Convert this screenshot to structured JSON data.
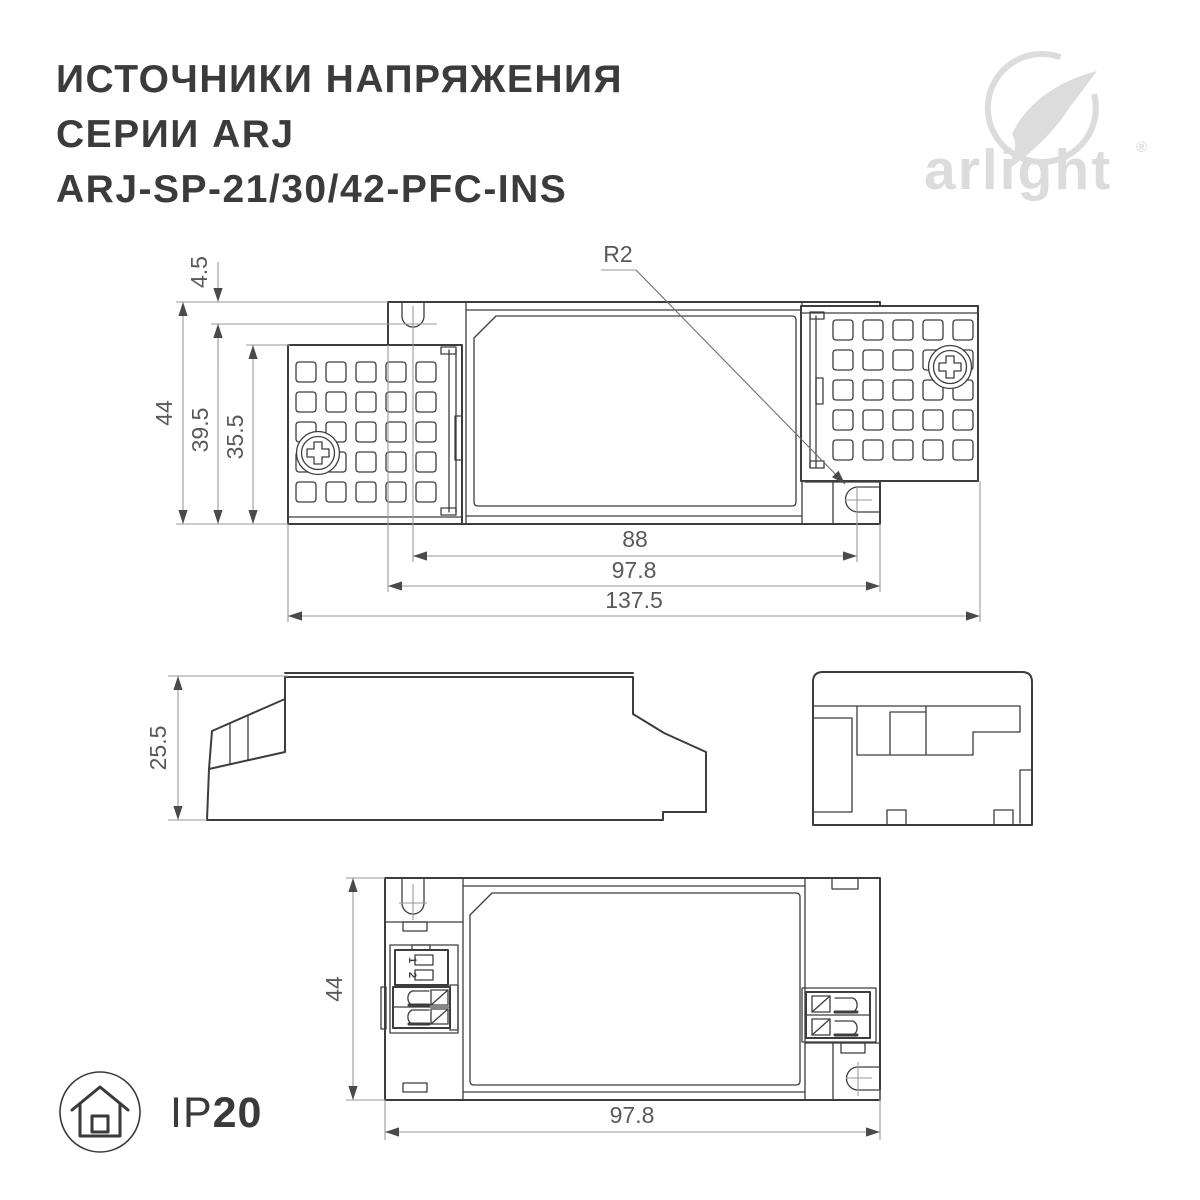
{
  "colors": {
    "line": "#3d3d3d",
    "dim": "#9a9a9a",
    "dimtext": "#595959",
    "arrow": "#4a4a4a",
    "title": "#3b3b3b",
    "logo": "#dcdcdc",
    "badge": "#3a3a3a"
  },
  "header": {
    "line1": "ИСТОЧНИКИ НАПРЯЖЕНИЯ",
    "line2": "СЕРИИ ARJ",
    "line3": "ARJ-SP-21/30/42-PFC-INS"
  },
  "logo": {
    "wordmark": "arlight",
    "registered": "®"
  },
  "views": {
    "top": {
      "d44": "44",
      "d45": "4.5",
      "d395": "39.5",
      "d355": "35.5",
      "d88": "88",
      "d978": "97.8",
      "d1375": "137.5",
      "r2": "R2"
    },
    "side": {
      "d255": "25.5"
    },
    "bottom": {
      "d44": "44",
      "d978": "97.8",
      "dip1": "1",
      "dip2": "2"
    }
  },
  "badge": {
    "prefix": "IP",
    "value": "20"
  }
}
